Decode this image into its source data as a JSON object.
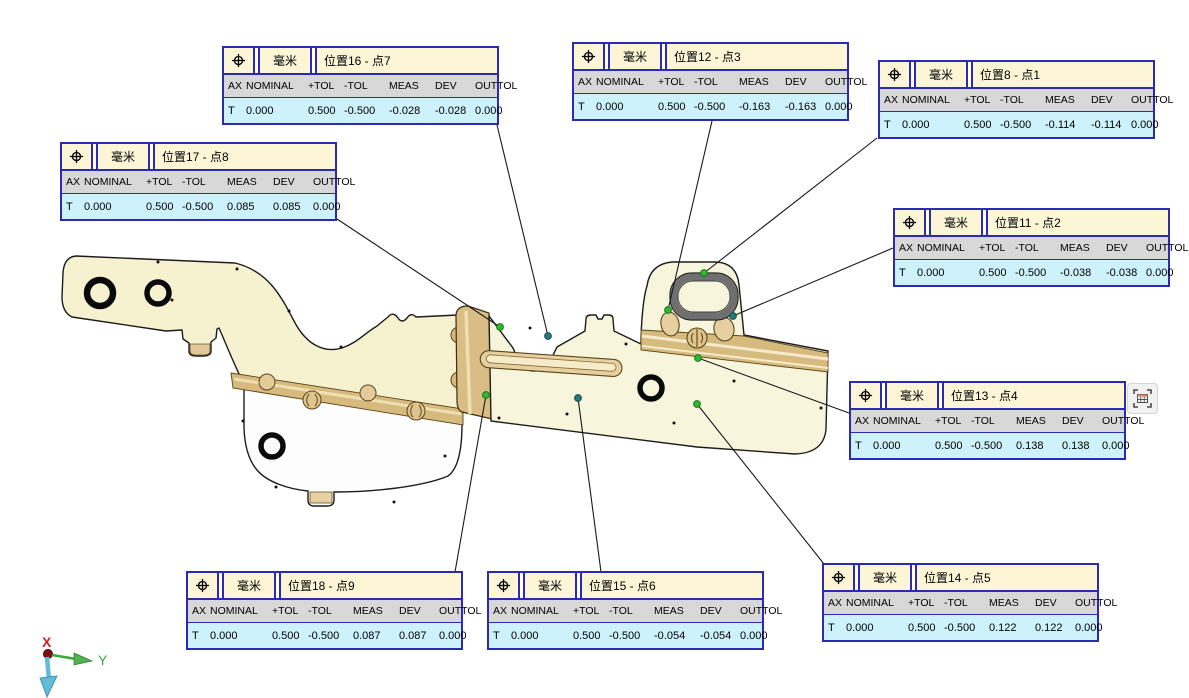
{
  "app": {
    "background": "#ffffff",
    "view": "CMM measurement results viewport"
  },
  "unit_label": "毫米",
  "columns": [
    "AX",
    "NOMINAL",
    "+TOL",
    "-TOL",
    "MEAS",
    "DEV",
    "OUTTOL"
  ],
  "callouts": [
    {
      "title": "位置8 - 点1",
      "values": [
        "T",
        "0.000",
        "0.500",
        "-0.500",
        "-0.114",
        "-0.114",
        "0.000"
      ]
    },
    {
      "title": "位置11 - 点2",
      "values": [
        "T",
        "0.000",
        "0.500",
        "-0.500",
        "-0.038",
        "-0.038",
        "0.000"
      ]
    },
    {
      "title": "位置12 - 点3",
      "values": [
        "T",
        "0.000",
        "0.500",
        "-0.500",
        "-0.163",
        "-0.163",
        "0.000"
      ]
    },
    {
      "title": "位置13 - 点4",
      "values": [
        "T",
        "0.000",
        "0.500",
        "-0.500",
        "0.138",
        "0.138",
        "0.000"
      ]
    },
    {
      "title": "位置14 - 点5",
      "values": [
        "T",
        "0.000",
        "0.500",
        "-0.500",
        "0.122",
        "0.122",
        "0.000"
      ]
    },
    {
      "title": "位置15 - 点6",
      "values": [
        "T",
        "0.000",
        "0.500",
        "-0.500",
        "-0.054",
        "-0.054",
        "0.000"
      ]
    },
    {
      "title": "位置16 - 点7",
      "values": [
        "T",
        "0.000",
        "0.500",
        "-0.500",
        "-0.028",
        "-0.028",
        "0.000"
      ]
    },
    {
      "title": "位置17 - 点8",
      "values": [
        "T",
        "0.000",
        "0.500",
        "-0.500",
        "0.085",
        "0.085",
        "0.000"
      ]
    },
    {
      "title": "位置18 - 点9",
      "values": [
        "T",
        "0.000",
        "0.500",
        "-0.500",
        "0.087",
        "0.087",
        "0.000"
      ]
    }
  ],
  "axis_triad": {
    "x_label": "X",
    "y_label": "Y"
  },
  "icons": {
    "label_symbol": "position-crosshair-icon",
    "corner_button": "table-frame-icon"
  },
  "colors": {
    "label_border": "#2a2ab2",
    "label_title_bg": "#fcf5d6",
    "label_header_bg": "#d8d8d8",
    "label_value_bg": "#cdf2fc",
    "part_fill": "#f6f2d0",
    "flange_tan": "#d7ba7e",
    "point_green": "#2eb82e",
    "point_teal": "#26767a",
    "axis_x": "#cc2222",
    "axis_y": "#3aa83a",
    "axis_z": "#62bcd8"
  }
}
